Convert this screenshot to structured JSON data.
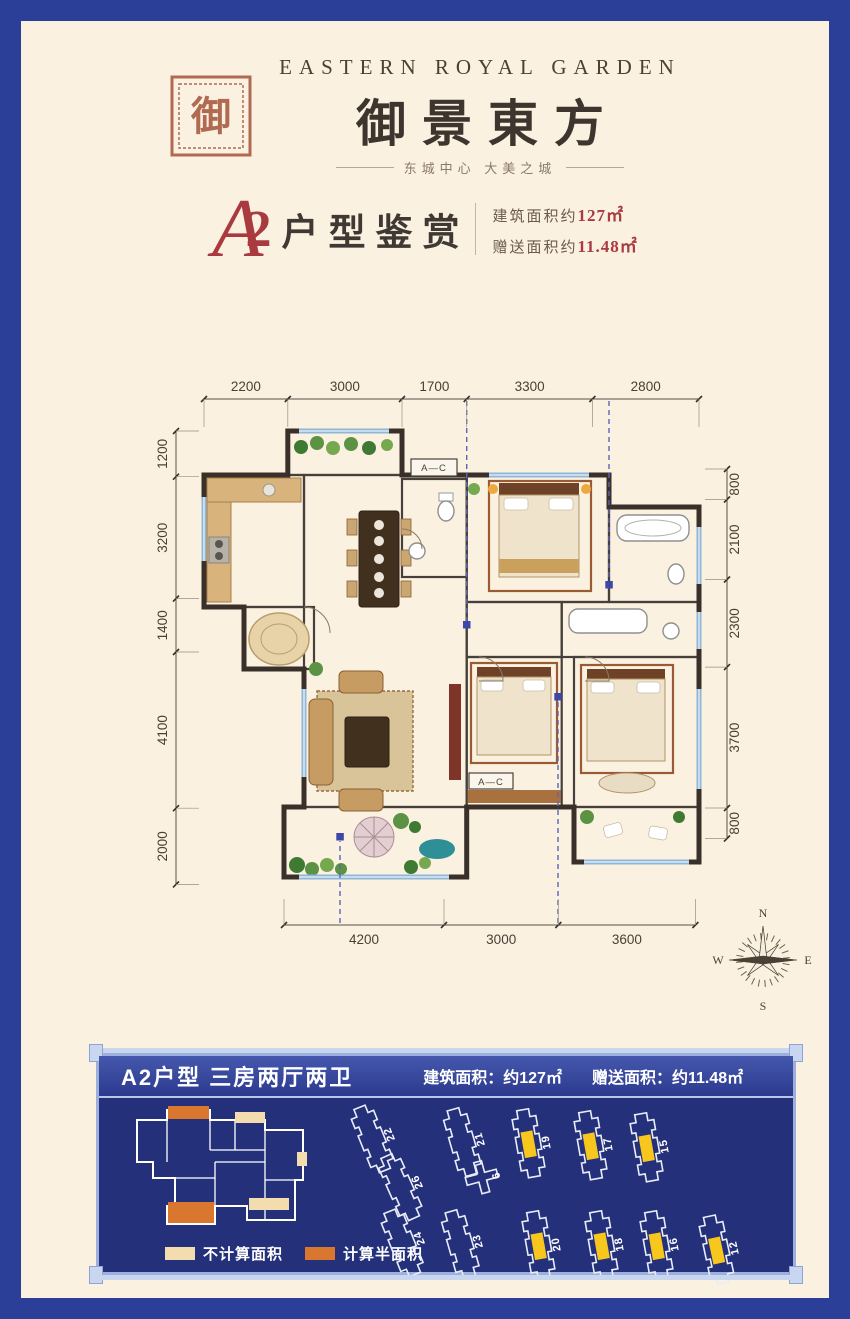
{
  "header": {
    "brand_en": "EASTERN ROYAL GARDEN",
    "brand_cn": "御景東方",
    "tagline": "东城中心  大美之城",
    "seal_char": "御"
  },
  "title": {
    "script_letter": "A",
    "number": "2",
    "text": "户型鉴赏",
    "area_label": "建筑面积约",
    "area_value": "127㎡",
    "gift_label": "赠送面积约",
    "gift_value": "11.48㎡"
  },
  "floorplan": {
    "dims_top": [
      "2200",
      "3000",
      "1700",
      "3300",
      "2800"
    ],
    "dims_left": [
      "1200",
      "3200",
      "1400",
      "4100",
      "2000"
    ],
    "dims_right": [
      "800",
      "2100",
      "2300",
      "3700",
      "800"
    ],
    "dims_bottom": [
      "4200",
      "3000",
      "3600"
    ],
    "ac_label_top": "A—C",
    "ac_label_bottom": "A—C"
  },
  "compass": {
    "n": "N",
    "e": "E",
    "s": "S",
    "w": "W"
  },
  "panel": {
    "title": "A2户型  三房两厅两卫",
    "area_text": "建筑面积：约127㎡",
    "gift_text": "赠送面积：约11.48㎡",
    "legend": [
      {
        "label": "不计算面积",
        "color": "#f3ddae"
      },
      {
        "label": "计算半面积",
        "color": "#d9772e"
      }
    ],
    "buildings": [
      {
        "label": "22",
        "highlighted": false
      },
      {
        "label": "21",
        "highlighted": false
      },
      {
        "label": "19",
        "highlighted": true
      },
      {
        "label": "17",
        "highlighted": true
      },
      {
        "label": "15",
        "highlighted": true
      },
      {
        "label": "26",
        "highlighted": false
      },
      {
        "label": "6",
        "highlighted": false
      },
      {
        "label": "24",
        "highlighted": false
      },
      {
        "label": "23",
        "highlighted": false
      },
      {
        "label": "20",
        "highlighted": true
      },
      {
        "label": "18",
        "highlighted": true
      },
      {
        "label": "16",
        "highlighted": true
      },
      {
        "label": "12",
        "highlighted": true
      }
    ],
    "highlight_color": "#f7c71d"
  },
  "colors": {
    "frame_blue": "#2b3f98",
    "paper_cream": "#fbf1e1",
    "accent_red": "#a93a40",
    "panel_navy": "#25307b"
  }
}
